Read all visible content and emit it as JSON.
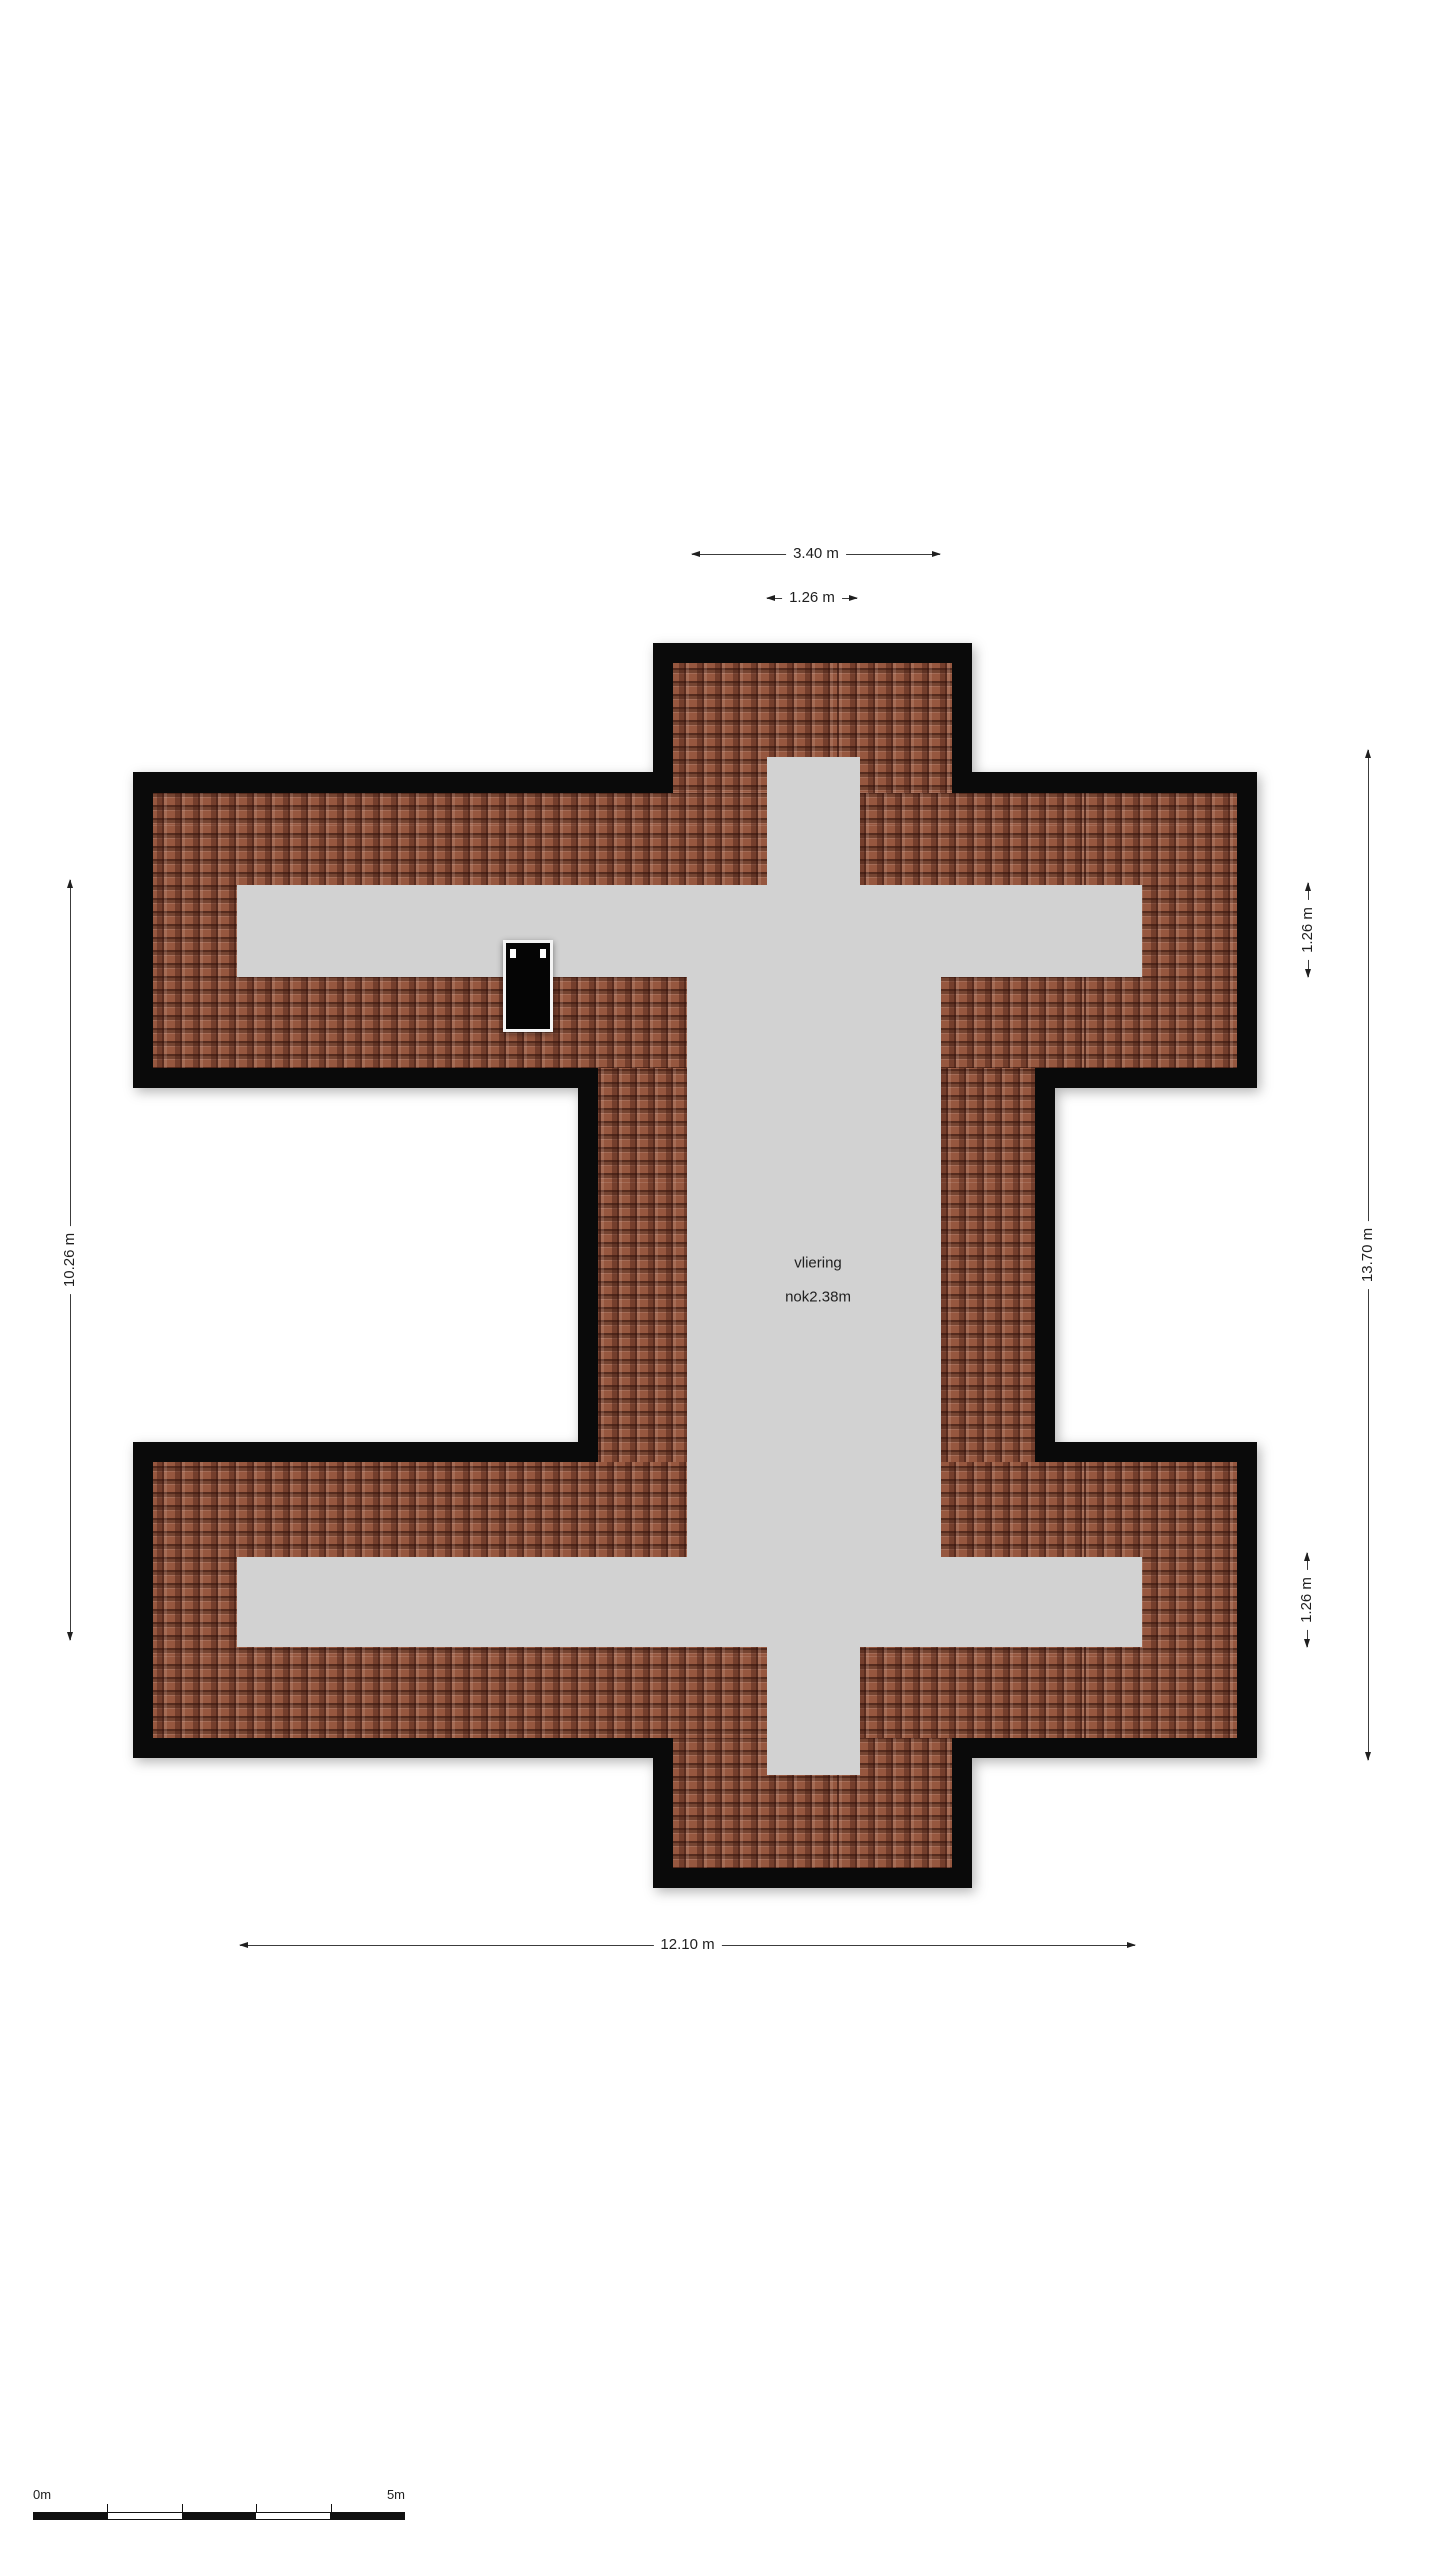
{
  "plan": {
    "type": "floor-plan",
    "room": {
      "name": "vliering",
      "ridge_height": "nok2.38m"
    },
    "colors": {
      "background": "#ffffff",
      "outline": "#0a0a0a",
      "roof_tile": "#96573f",
      "roof_tile_dark": "#3a1710",
      "floor_gray": "#d2d2d2",
      "dimension_text": "#1f1f1f",
      "window_fill": "#050505",
      "window_frame": "#f4f4f4"
    },
    "dimensions": [
      {
        "id": "top-outer-width",
        "label": "3.40 m",
        "orientation": "horizontal"
      },
      {
        "id": "top-corridor-width",
        "label": "1.26 m",
        "orientation": "horizontal"
      },
      {
        "id": "left-overall-height",
        "label": "10.26 m",
        "orientation": "vertical"
      },
      {
        "id": "right-overall-height",
        "label": "13.70 m",
        "orientation": "vertical"
      },
      {
        "id": "right-upper-band",
        "label": "1.26 m",
        "orientation": "vertical"
      },
      {
        "id": "right-lower-band",
        "label": "1.26 m",
        "orientation": "vertical"
      },
      {
        "id": "bottom-inner-width",
        "label": "12.10 m",
        "orientation": "horizontal"
      }
    ],
    "scale_bar": {
      "start_label": "0m",
      "end_label": "5m",
      "segments": 5
    }
  }
}
